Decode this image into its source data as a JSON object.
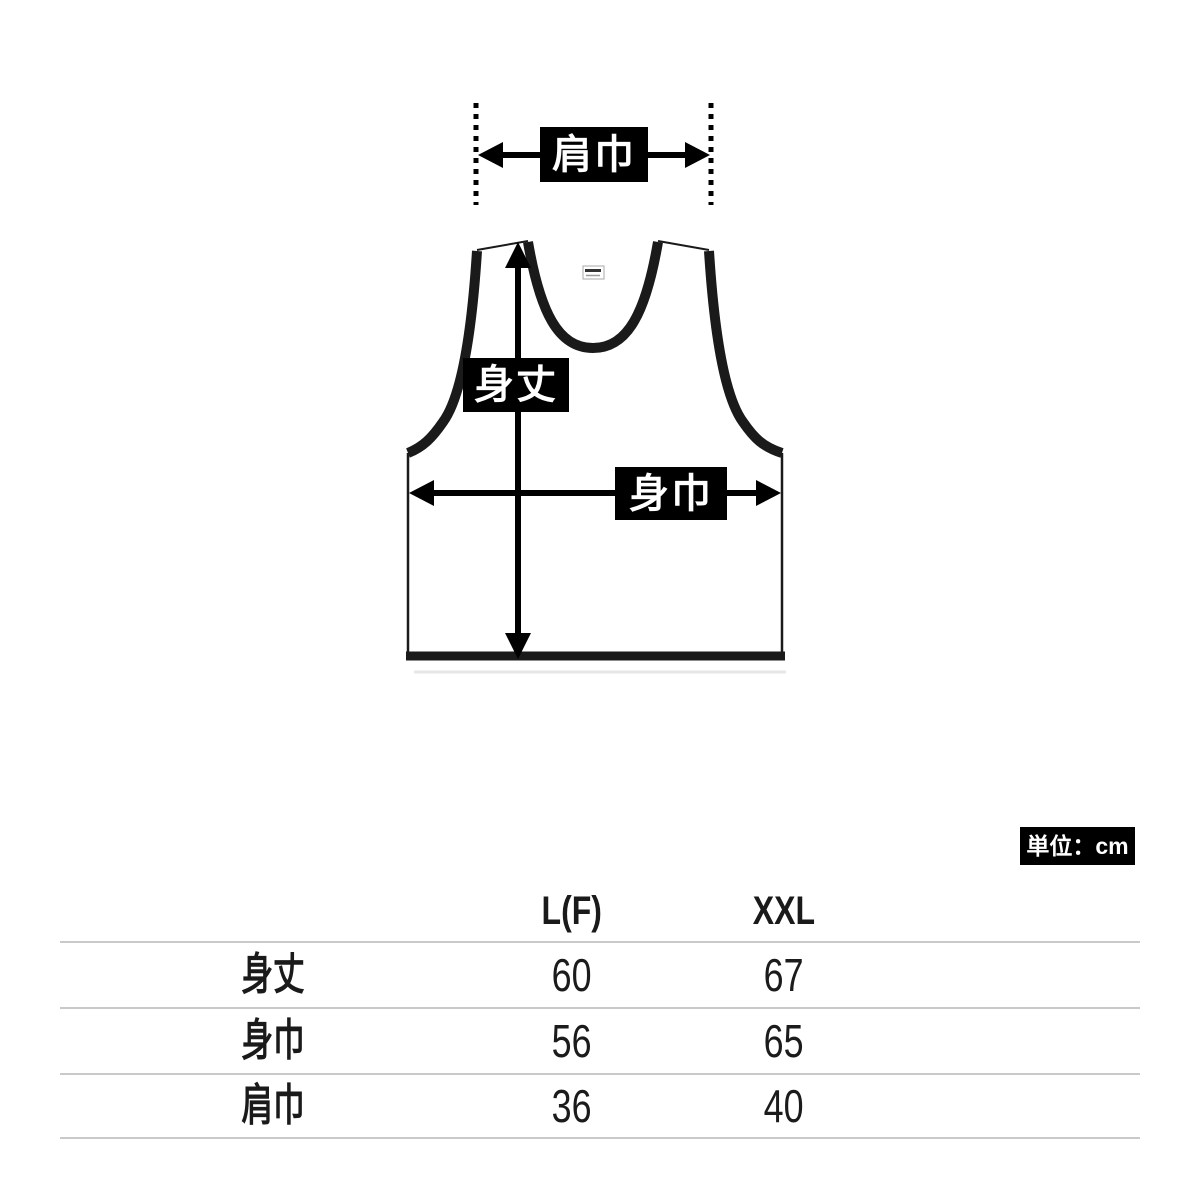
{
  "diagram": {
    "shoulder_width_label": "肩巾",
    "body_length_label": "身丈",
    "body_width_label": "身巾",
    "unit_badge": "単位：cm",
    "label_bg": "#000000",
    "label_text_color": "#ffffff",
    "outline_color": "#1a1a1a"
  },
  "size_table": {
    "columns": [
      "L(F)",
      "XXL"
    ],
    "rows": [
      {
        "label": "身丈",
        "values": [
          "60",
          "67"
        ]
      },
      {
        "label": "身巾",
        "values": [
          "56",
          "65"
        ]
      },
      {
        "label": "肩巾",
        "values": [
          "36",
          "40"
        ]
      }
    ],
    "divider_color": "#c9c9c9"
  }
}
